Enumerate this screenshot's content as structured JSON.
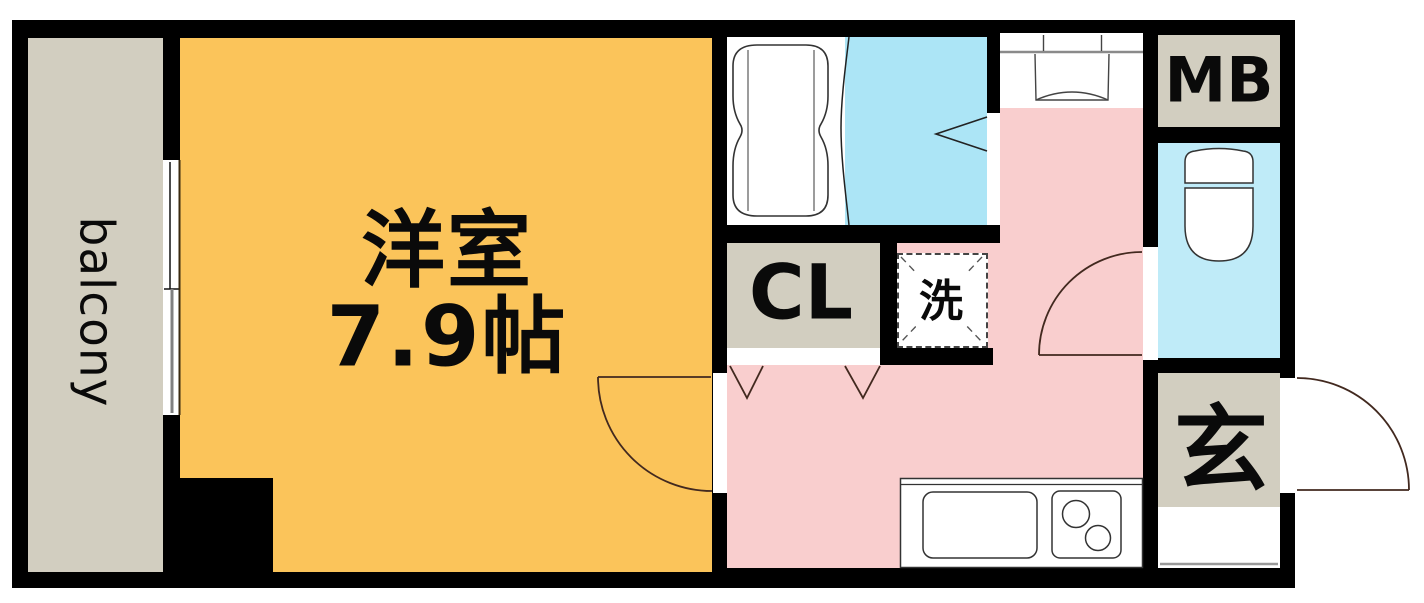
{
  "plan_title": "1K apartment floor plan",
  "rooms": {
    "balcony": {
      "label": "balcony"
    },
    "main_room": {
      "name_label": "洋室",
      "size_label": "7.9帖"
    },
    "closet": {
      "label": "CL"
    },
    "laundry": {
      "label": "洗"
    },
    "meter_box": {
      "label": "MB"
    },
    "entrance": {
      "label": "玄"
    }
  },
  "colors": {
    "wall": "#000000",
    "main_room_fill": "#FBC45A",
    "balcony_fill": "#D2CEC0",
    "closet_fill": "#D2CEC0",
    "meter_box_fill": "#D2CEC0",
    "entrance_fill": "#D2CEC0",
    "hall_kitchen_fill": "#F9CECE",
    "bath_floor_fill": "#ACE5F6",
    "toilet_room_fill": "#BFEBF8",
    "door_swing_line": "#42291F",
    "fixture_line": "#333333"
  }
}
